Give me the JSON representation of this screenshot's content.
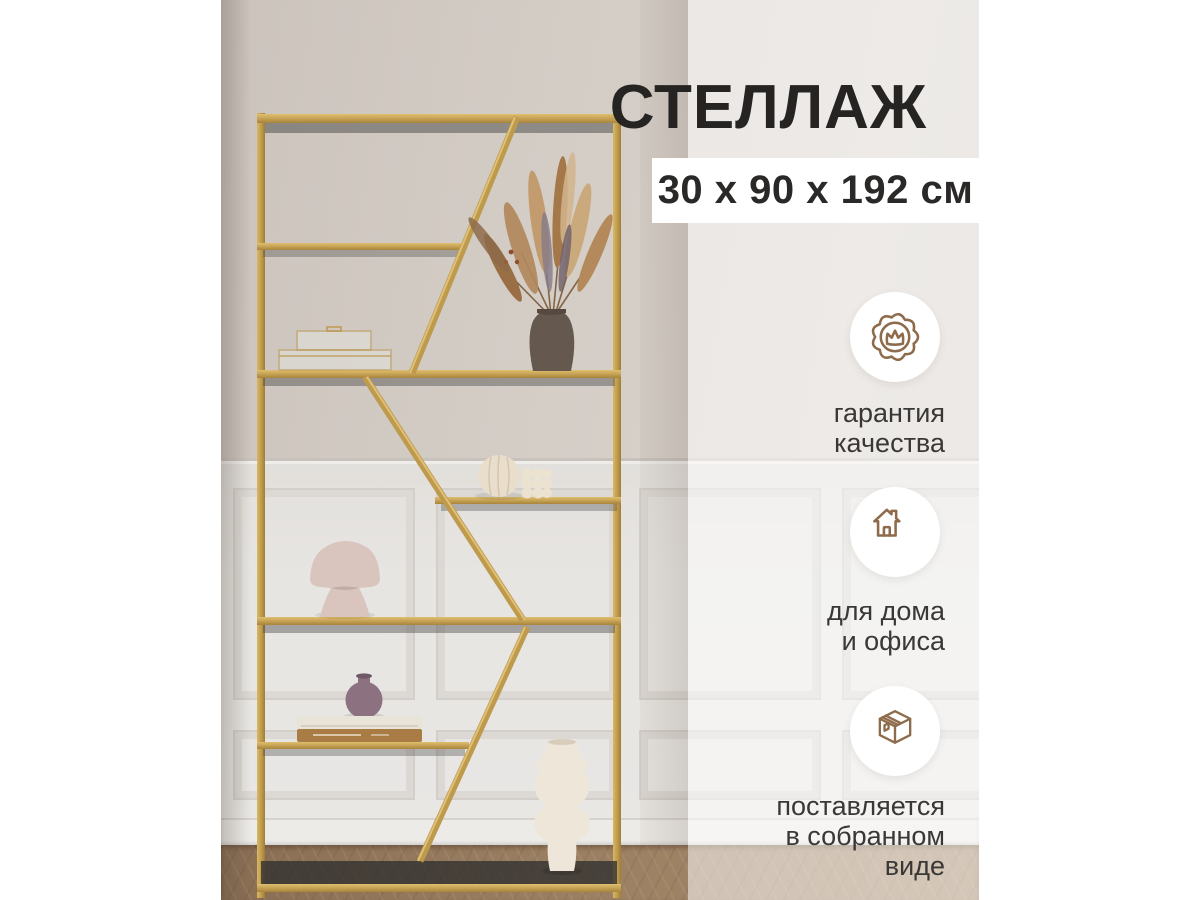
{
  "title": "СТЕЛЛАЖ",
  "badge": {
    "dimensions": "30 х 90 х 192 см"
  },
  "features": [
    {
      "icon": "quality-seal",
      "lines": [
        "гарантия",
        "качества"
      ]
    },
    {
      "icon": "home",
      "lines": [
        "для дома",
        "и офиса"
      ]
    },
    {
      "icon": "package-box",
      "lines": [
        "поставляется",
        "в собранном",
        "виде"
      ]
    }
  ],
  "colors": {
    "accent_gold": "#C6A254",
    "icon_brown": "#8E6C4B",
    "title_text": "#262423",
    "badge_bg": "#FFFFFF",
    "label_text": "#3A3836"
  }
}
